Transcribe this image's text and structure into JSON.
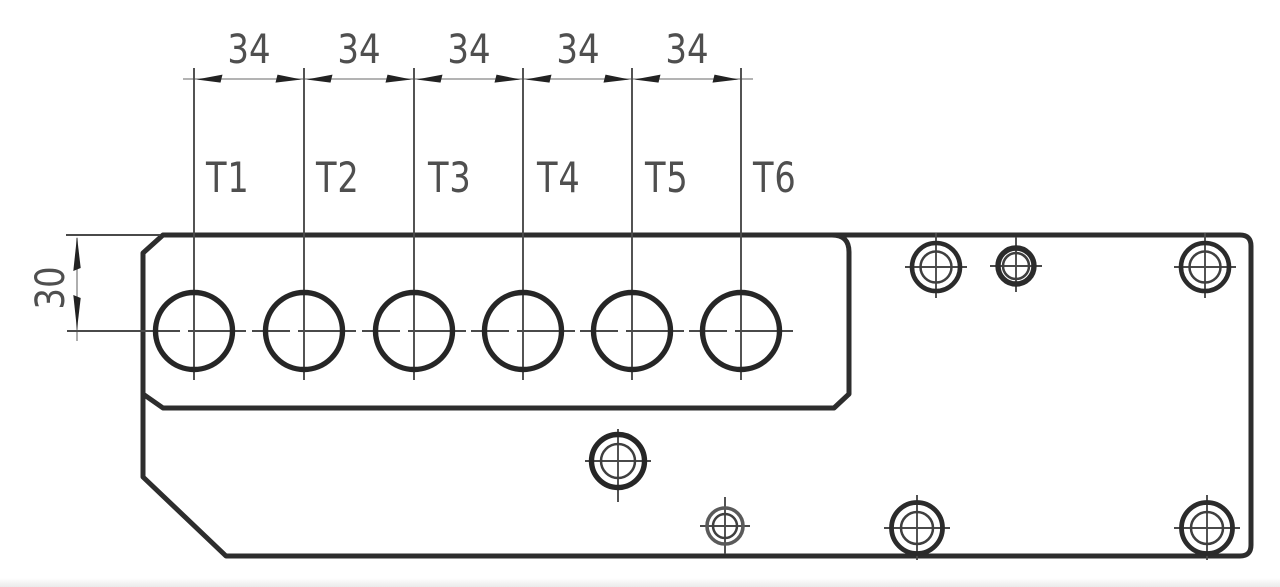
{
  "colors": {
    "outline": "#2d2d2d",
    "thin_line": "#4a4a4a",
    "text": "#4f4f4f"
  },
  "dimensions": {
    "pitch_labels": [
      "34",
      "34",
      "34",
      "34",
      "34"
    ],
    "height_label": "30"
  },
  "hole_labels": [
    "T1",
    "T2",
    "T3",
    "T4",
    "T5",
    "T6"
  ]
}
